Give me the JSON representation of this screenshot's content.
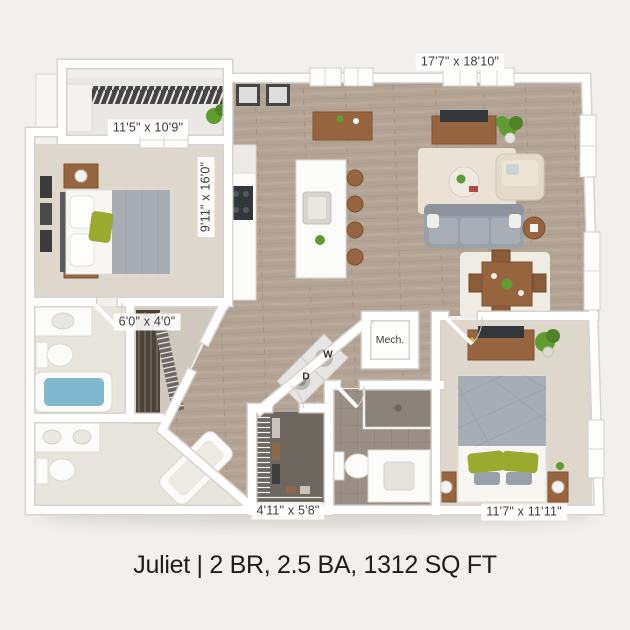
{
  "caption": "Juliet | 2 BR, 2.5 BA, 1312 SQ FT",
  "plan": {
    "rooms": [
      {
        "id": "bedroom-1",
        "dim": "11'5\" x 10'9\""
      },
      {
        "id": "living-room",
        "dim": "17'7\" x 18'10\""
      },
      {
        "id": "kitchen",
        "dim": "9'11\" x 16'0\""
      },
      {
        "id": "closet",
        "dim": "6'0\" x 4'0\""
      },
      {
        "id": "walkin-closet",
        "dim": "4'11\" x 5'8\""
      },
      {
        "id": "bedroom-2",
        "dim": "11'7\" x 11'11\""
      }
    ],
    "labels": {
      "mech": "Mech.",
      "washer": "W",
      "dryer": "D"
    }
  },
  "colors": {
    "bg": "#f2f0ee",
    "wall": "#ffffff",
    "wood": "#b2a395",
    "carpet": "#ded7cb",
    "tileLight": "#e7e4de",
    "tileDark": "#998f85",
    "closetDark": "#6e675f",
    "balconyFloor": "#eae8e4",
    "sofa": "#9ba1a9",
    "rug": "#eae2d4",
    "furnitureWood": "#96653f",
    "furnitureWoodDark": "#7d5233",
    "tvDark": "#33363a",
    "plantGreen": "#5f9c31",
    "pillowGreen": "#9aaa2e",
    "bedGray": "#a7adb5",
    "water": "#7fb8cf",
    "labelText": "#3b3b3b",
    "captionText": "#1d1d1d"
  }
}
